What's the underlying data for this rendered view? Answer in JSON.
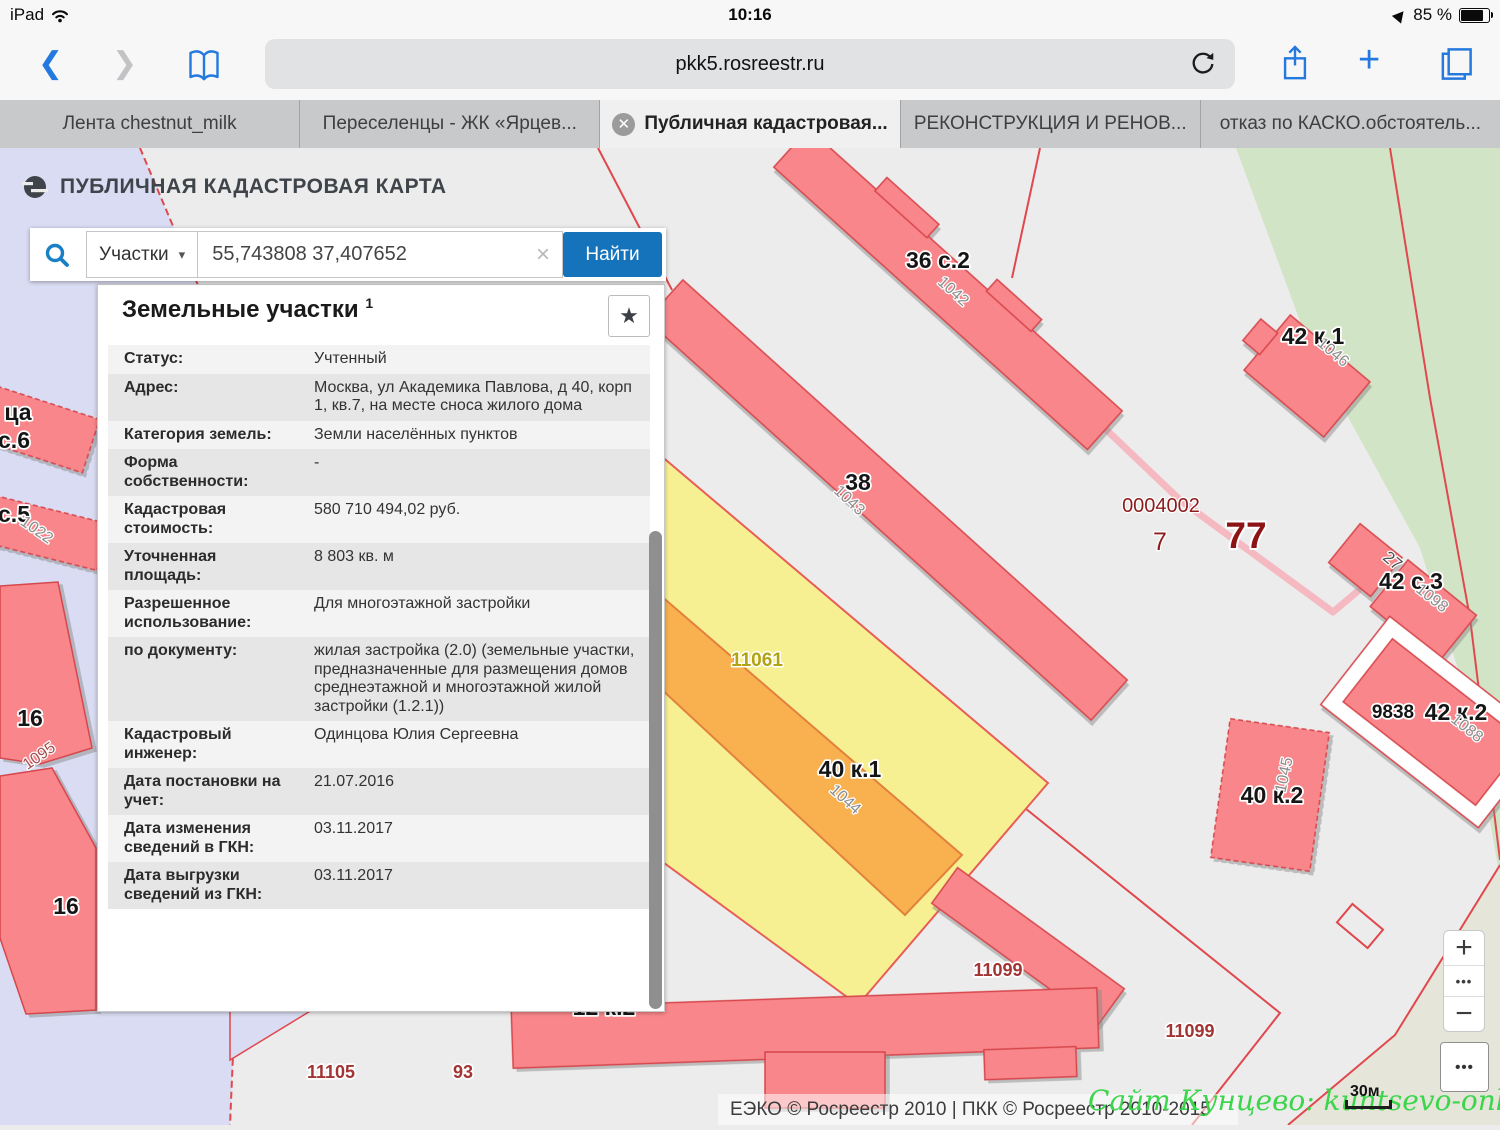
{
  "status_bar": {
    "device": "iPad",
    "time": "10:16",
    "battery_percent": "85 %"
  },
  "browser": {
    "url": "pkk5.rosreestr.ru",
    "tabs": [
      {
        "label": "Лента chestnut_milk",
        "active": false
      },
      {
        "label": "Переселенцы - ЖК «Ярцев...",
        "active": false
      },
      {
        "label": "Публичная кадастровая...",
        "active": true
      },
      {
        "label": "РЕКОНСТРУКЦИЯ И РЕНОВ...",
        "active": false
      },
      {
        "label": "отказ по КАСКО.обстоятель...",
        "active": false
      }
    ]
  },
  "map_header": {
    "title": "ПУБЛИЧНАЯ КАДАСТРОВАЯ КАРТА"
  },
  "search": {
    "category": "Участки",
    "query": "55,743808 37,407652",
    "button": "Найти",
    "clear": "×",
    "caret": "▾"
  },
  "panel": {
    "title": "Земельные участки",
    "superscript": "1",
    "star": "★",
    "rows": [
      {
        "label": "Статус:",
        "value": "Учтенный"
      },
      {
        "label": "Адрес:",
        "value": "Москва, ул Академика Павлова, д 40, корп 1, кв.7, на месте сноса жилого дома"
      },
      {
        "label": "Категория земель:",
        "value": "Земли населённых пунктов"
      },
      {
        "label": "Форма собственности:",
        "value": "-"
      },
      {
        "label": "Кадастровая стоимость:",
        "value": "580 710 494,02 руб."
      },
      {
        "label": "Уточненная площадь:",
        "value": "8 803 кв. м"
      },
      {
        "label": "Разрешенное использование:",
        "value": "Для многоэтажной застройки"
      },
      {
        "label": "по документу:",
        "value": "жилая застройка (2.0) (земельные участки, предназначенные для размещения домов среднеэтажной и многоэтажной жилой застройки (1.2.1))"
      },
      {
        "label": "Кадастровый инженер:",
        "value": "Одинцова Юлия Сергеевна"
      },
      {
        "label": "Дата постановки на учет:",
        "value": "21.07.2016"
      },
      {
        "label": "Дата изменения сведений в ГКН:",
        "value": "03.11.2017"
      },
      {
        "label": "Дата выгрузки сведений из ГКН:",
        "value": "03.11.2017"
      }
    ]
  },
  "map": {
    "footer": "ЕЭКО © Росреестр 2010 | ПКК © Росреестр 2010-2015",
    "watermark": "Сайт Кунцево:  kuntsevo-online.ru",
    "scale": "30м",
    "controls": {
      "zoom_in": "+",
      "zoom_out": "−",
      "dots": "•••"
    },
    "colors": {
      "parcel_red": "#f9868a",
      "selected_yellow": "#f6f092",
      "building_orange": "#f8b14e",
      "lavender": "#d9dcf2",
      "green": "#d2e4c6",
      "accent_blue": "#1473ba"
    },
    "labels": [
      {
        "t": "36 с.2",
        "x": 938,
        "y": 120,
        "c": "big"
      },
      {
        "t": "1042",
        "x": 950,
        "y": 147,
        "r": 42,
        "c": "rot"
      },
      {
        "t": "42 к.1",
        "x": 1313,
        "y": 196,
        "c": "big"
      },
      {
        "t": "1046",
        "x": 1330,
        "y": 208,
        "r": 40,
        "c": "rot"
      },
      {
        "t": "38",
        "x": 858,
        "y": 342,
        "c": "big"
      },
      {
        "t": "1043",
        "x": 846,
        "y": 356,
        "r": 43,
        "c": "rot"
      },
      {
        "t": "0004002",
        "x": 1161,
        "y": 364,
        "c": "num"
      },
      {
        "t": "7",
        "x": 1160,
        "y": 402,
        "c": "num7"
      },
      {
        "t": "77",
        "x": 1246,
        "y": 400,
        "c": "num77"
      },
      {
        "t": "27",
        "x": 1389,
        "y": 417,
        "r": 40,
        "c": "rotd"
      },
      {
        "t": "42 с.3",
        "x": 1411,
        "y": 441,
        "c": "big"
      },
      {
        "t": "1098",
        "x": 1429,
        "y": 454,
        "r": 38,
        "c": "rot"
      },
      {
        "t": "9838",
        "x": 1393,
        "y": 570,
        "c": "med"
      },
      {
        "t": "42 к.2",
        "x": 1456,
        "y": 572,
        "c": "big"
      },
      {
        "t": "1088",
        "x": 1464,
        "y": 584,
        "r": 38,
        "c": "rot"
      },
      {
        "t": "11061",
        "x": 757,
        "y": 518,
        "c": "olive"
      },
      {
        "t": "40 к.1",
        "x": 850,
        "y": 629,
        "c": "big"
      },
      {
        "t": "1044",
        "x": 842,
        "y": 655,
        "r": 42,
        "c": "rot"
      },
      {
        "t": "40 к.2",
        "x": 1272,
        "y": 655,
        "c": "big"
      },
      {
        "t": "1045",
        "x": 1289,
        "y": 628,
        "r": -78,
        "c": "rot"
      },
      {
        "t": "11099",
        "x": 998,
        "y": 828,
        "c": "red"
      },
      {
        "t": "11099",
        "x": 1190,
        "y": 889,
        "c": "red"
      },
      {
        "t": "12 к.2",
        "x": 604,
        "y": 867,
        "c": "big"
      },
      {
        "t": "11105",
        "x": 331,
        "y": 930,
        "c": "red"
      },
      {
        "t": "93",
        "x": 463,
        "y": 930,
        "c": "red"
      },
      {
        "t": "16",
        "x": 30,
        "y": 578,
        "c": "big"
      },
      {
        "t": "1095",
        "x": 42,
        "y": 612,
        "r": -35,
        "c": "rotr"
      },
      {
        "t": "16",
        "x": 66,
        "y": 766,
        "c": "big"
      },
      {
        "t": "ца",
        "x": 18,
        "y": 272,
        "c": "big"
      },
      {
        "t": "с.6",
        "x": 14,
        "y": 300,
        "c": "big"
      },
      {
        "t": "с.5",
        "x": 14,
        "y": 374,
        "c": "big"
      },
      {
        "t": "1022",
        "x": 34,
        "y": 386,
        "r": 35,
        "c": "rot"
      }
    ]
  }
}
